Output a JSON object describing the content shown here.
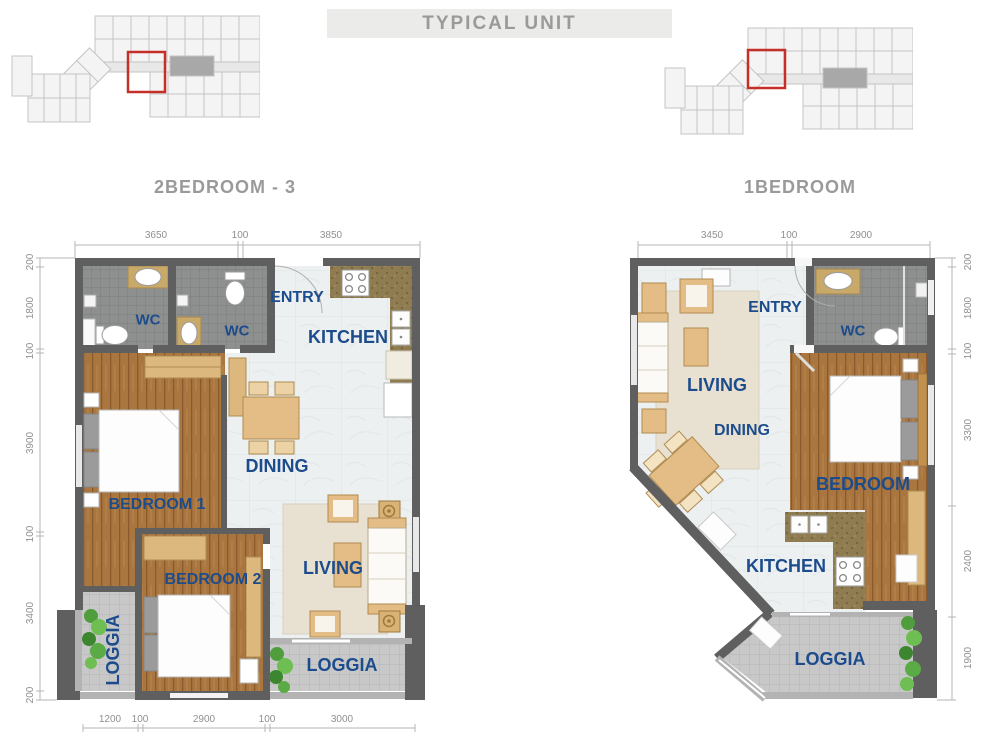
{
  "title": "TYPICAL UNIT",
  "plans": {
    "a": {
      "name": "2BEDROOM - 3",
      "labels": {
        "wc1": "WC",
        "wc2": "WC",
        "entry": "ENTRY",
        "kitchen": "KITCHEN",
        "dining": "DINING",
        "bedroom1": "BEDROOM 1",
        "bedroom2": "BEDROOM 2",
        "living": "LIVING",
        "loggia_side": "LOGGIA",
        "loggia_front": "LOGGIA"
      },
      "dims_top": [
        "3650",
        "100",
        "3850"
      ],
      "dims_left": [
        "200",
        "1800",
        "100",
        "3900",
        "100",
        "3400",
        "200"
      ],
      "dims_bottom": [
        "1200",
        "100",
        "2900",
        "100",
        "3000"
      ]
    },
    "b": {
      "name": "1BEDROOM",
      "labels": {
        "entry": "ENTRY",
        "wc": "WC",
        "living": "LIVING",
        "dining": "DINING",
        "bedroom": "BEDROOM",
        "kitchen": "KITCHEN",
        "loggia": "LOGGIA"
      },
      "dims_top": [
        "3450",
        "100",
        "2900"
      ],
      "dims_right": [
        "200",
        "1800",
        "100",
        "3300",
        "2400",
        "1900"
      ]
    }
  },
  "colors": {
    "label_navy": "#1d4c8c",
    "dimension_gray": "#8f8f8f",
    "title_gray": "#9a9a9a",
    "wall_gray": "#5f5f5f",
    "wood_brown": "#a9763f",
    "marble": "#edf0f1",
    "wc_tile": "#8e9090",
    "loggia_tile": "#c8c8c8",
    "furniture_tan": "#e3bd85",
    "highlight_red": "#c43028",
    "plant_green": "#4f9d3d"
  }
}
